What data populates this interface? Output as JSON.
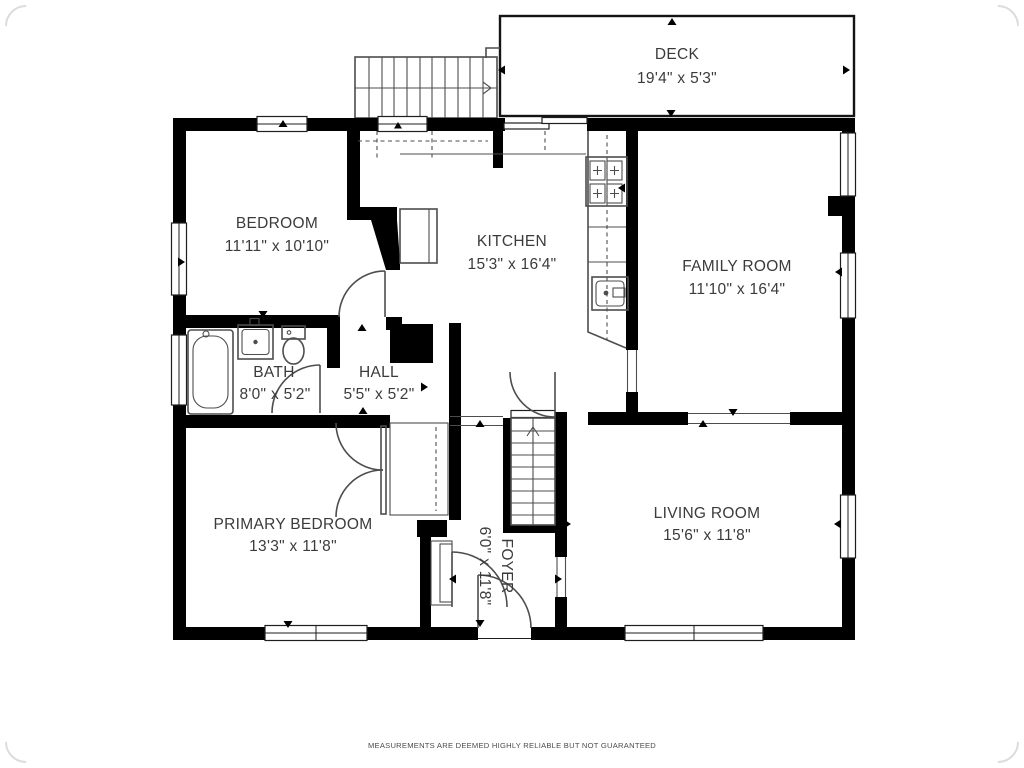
{
  "rooms": {
    "deck": {
      "name": "DECK",
      "dims": "19'4\" x 5'3\""
    },
    "bedroom": {
      "name": "BEDROOM",
      "dims": "11'11\" x 10'10\""
    },
    "kitchen": {
      "name": "KITCHEN",
      "dims": "15'3\" x 16'4\""
    },
    "family_room": {
      "name": "FAMILY ROOM",
      "dims": "11'10\" x 16'4\""
    },
    "bath": {
      "name": "BATH",
      "dims": "8'0\" x 5'2\""
    },
    "hall": {
      "name": "HALL",
      "dims": "5'5\" x 5'2\""
    },
    "primary_bedroom": {
      "name": "PRIMARY BEDROOM",
      "dims": "13'3\" x 11'8\""
    },
    "foyer": {
      "name": "FOYER",
      "dims": "6'0\" x 11'8\""
    },
    "living_room": {
      "name": "LIVING ROOM",
      "dims": "15'6\" x 11'8\""
    }
  },
  "disclaimer": "MEASUREMENTS ARE DEEMED HIGHLY RELIABLE BUT NOT GUARANTEED",
  "colors": {
    "wall": "#000000",
    "fixture_line": "#4d4d4d",
    "label_text": "#3b3b3b",
    "background": "#ffffff"
  }
}
